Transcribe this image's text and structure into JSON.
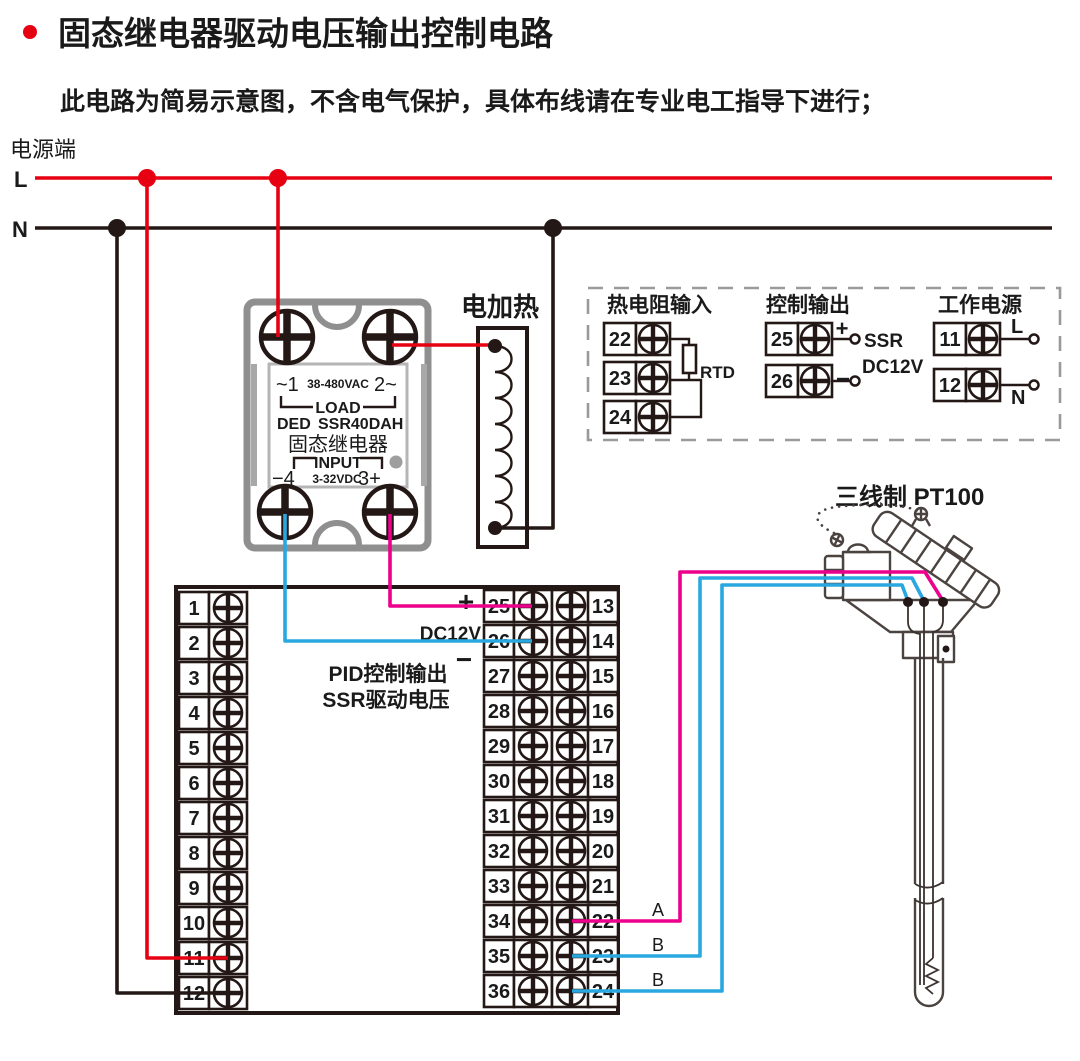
{
  "title": {
    "text": "固态继电器驱动电压输出控制电路",
    "subtitle": "此电路为简易示意图，不含电气保护，具体布线请在专业电工指导下进行；"
  },
  "power": {
    "label": "电源端",
    "l": "L",
    "n": "N"
  },
  "ssr": {
    "line1_left": "~1",
    "line1_mid": "38-480VAC",
    "line1_right": "2~",
    "load": "LOAD",
    "brand": "DED",
    "model": "SSR40DAH",
    "name": "固态继电器",
    "input": "INPUT",
    "in_left": "−4",
    "in_mid": "3-32VDC",
    "in_right": "3+"
  },
  "heater": {
    "label": "电加热"
  },
  "panel": {
    "rtd_in": {
      "title": "热电阻输入",
      "terminals": [
        "22",
        "23",
        "24"
      ],
      "rtd_label": "RTD"
    },
    "ctrl_out": {
      "title": "控制输出",
      "terminals": [
        "25",
        "26"
      ],
      "plus": "+",
      "minus": "−",
      "ssr_label": "SSR",
      "dc_label": "DC12V"
    },
    "work_pwr": {
      "title": "工作电源",
      "terminals": [
        "11",
        "12"
      ],
      "l": "L",
      "n": "N"
    }
  },
  "sensor": {
    "label": "三线制 PT100",
    "wire_a": "A",
    "wire_b1": "B",
    "wire_b2": "B"
  },
  "controller": {
    "plus": "+",
    "dc12v": "DC12V",
    "minus": "−",
    "pid_line1": "PID控制输出",
    "pid_line2": "SSR驱动电压",
    "left_terminals": [
      "1",
      "2",
      "3",
      "4",
      "5",
      "6",
      "7",
      "8",
      "9",
      "10",
      "11",
      "12"
    ],
    "mid_terminals": [
      "25",
      "26",
      "27",
      "28",
      "29",
      "30",
      "31",
      "32",
      "33",
      "34",
      "35",
      "36"
    ],
    "right_terminals": [
      "13",
      "14",
      "15",
      "16",
      "17",
      "18",
      "19",
      "20",
      "21",
      "22",
      "23",
      "24"
    ]
  },
  "colors": {
    "red": "#e60012",
    "magenta": "#ec008c",
    "cyan": "#29a8e0",
    "black": "#231815"
  }
}
